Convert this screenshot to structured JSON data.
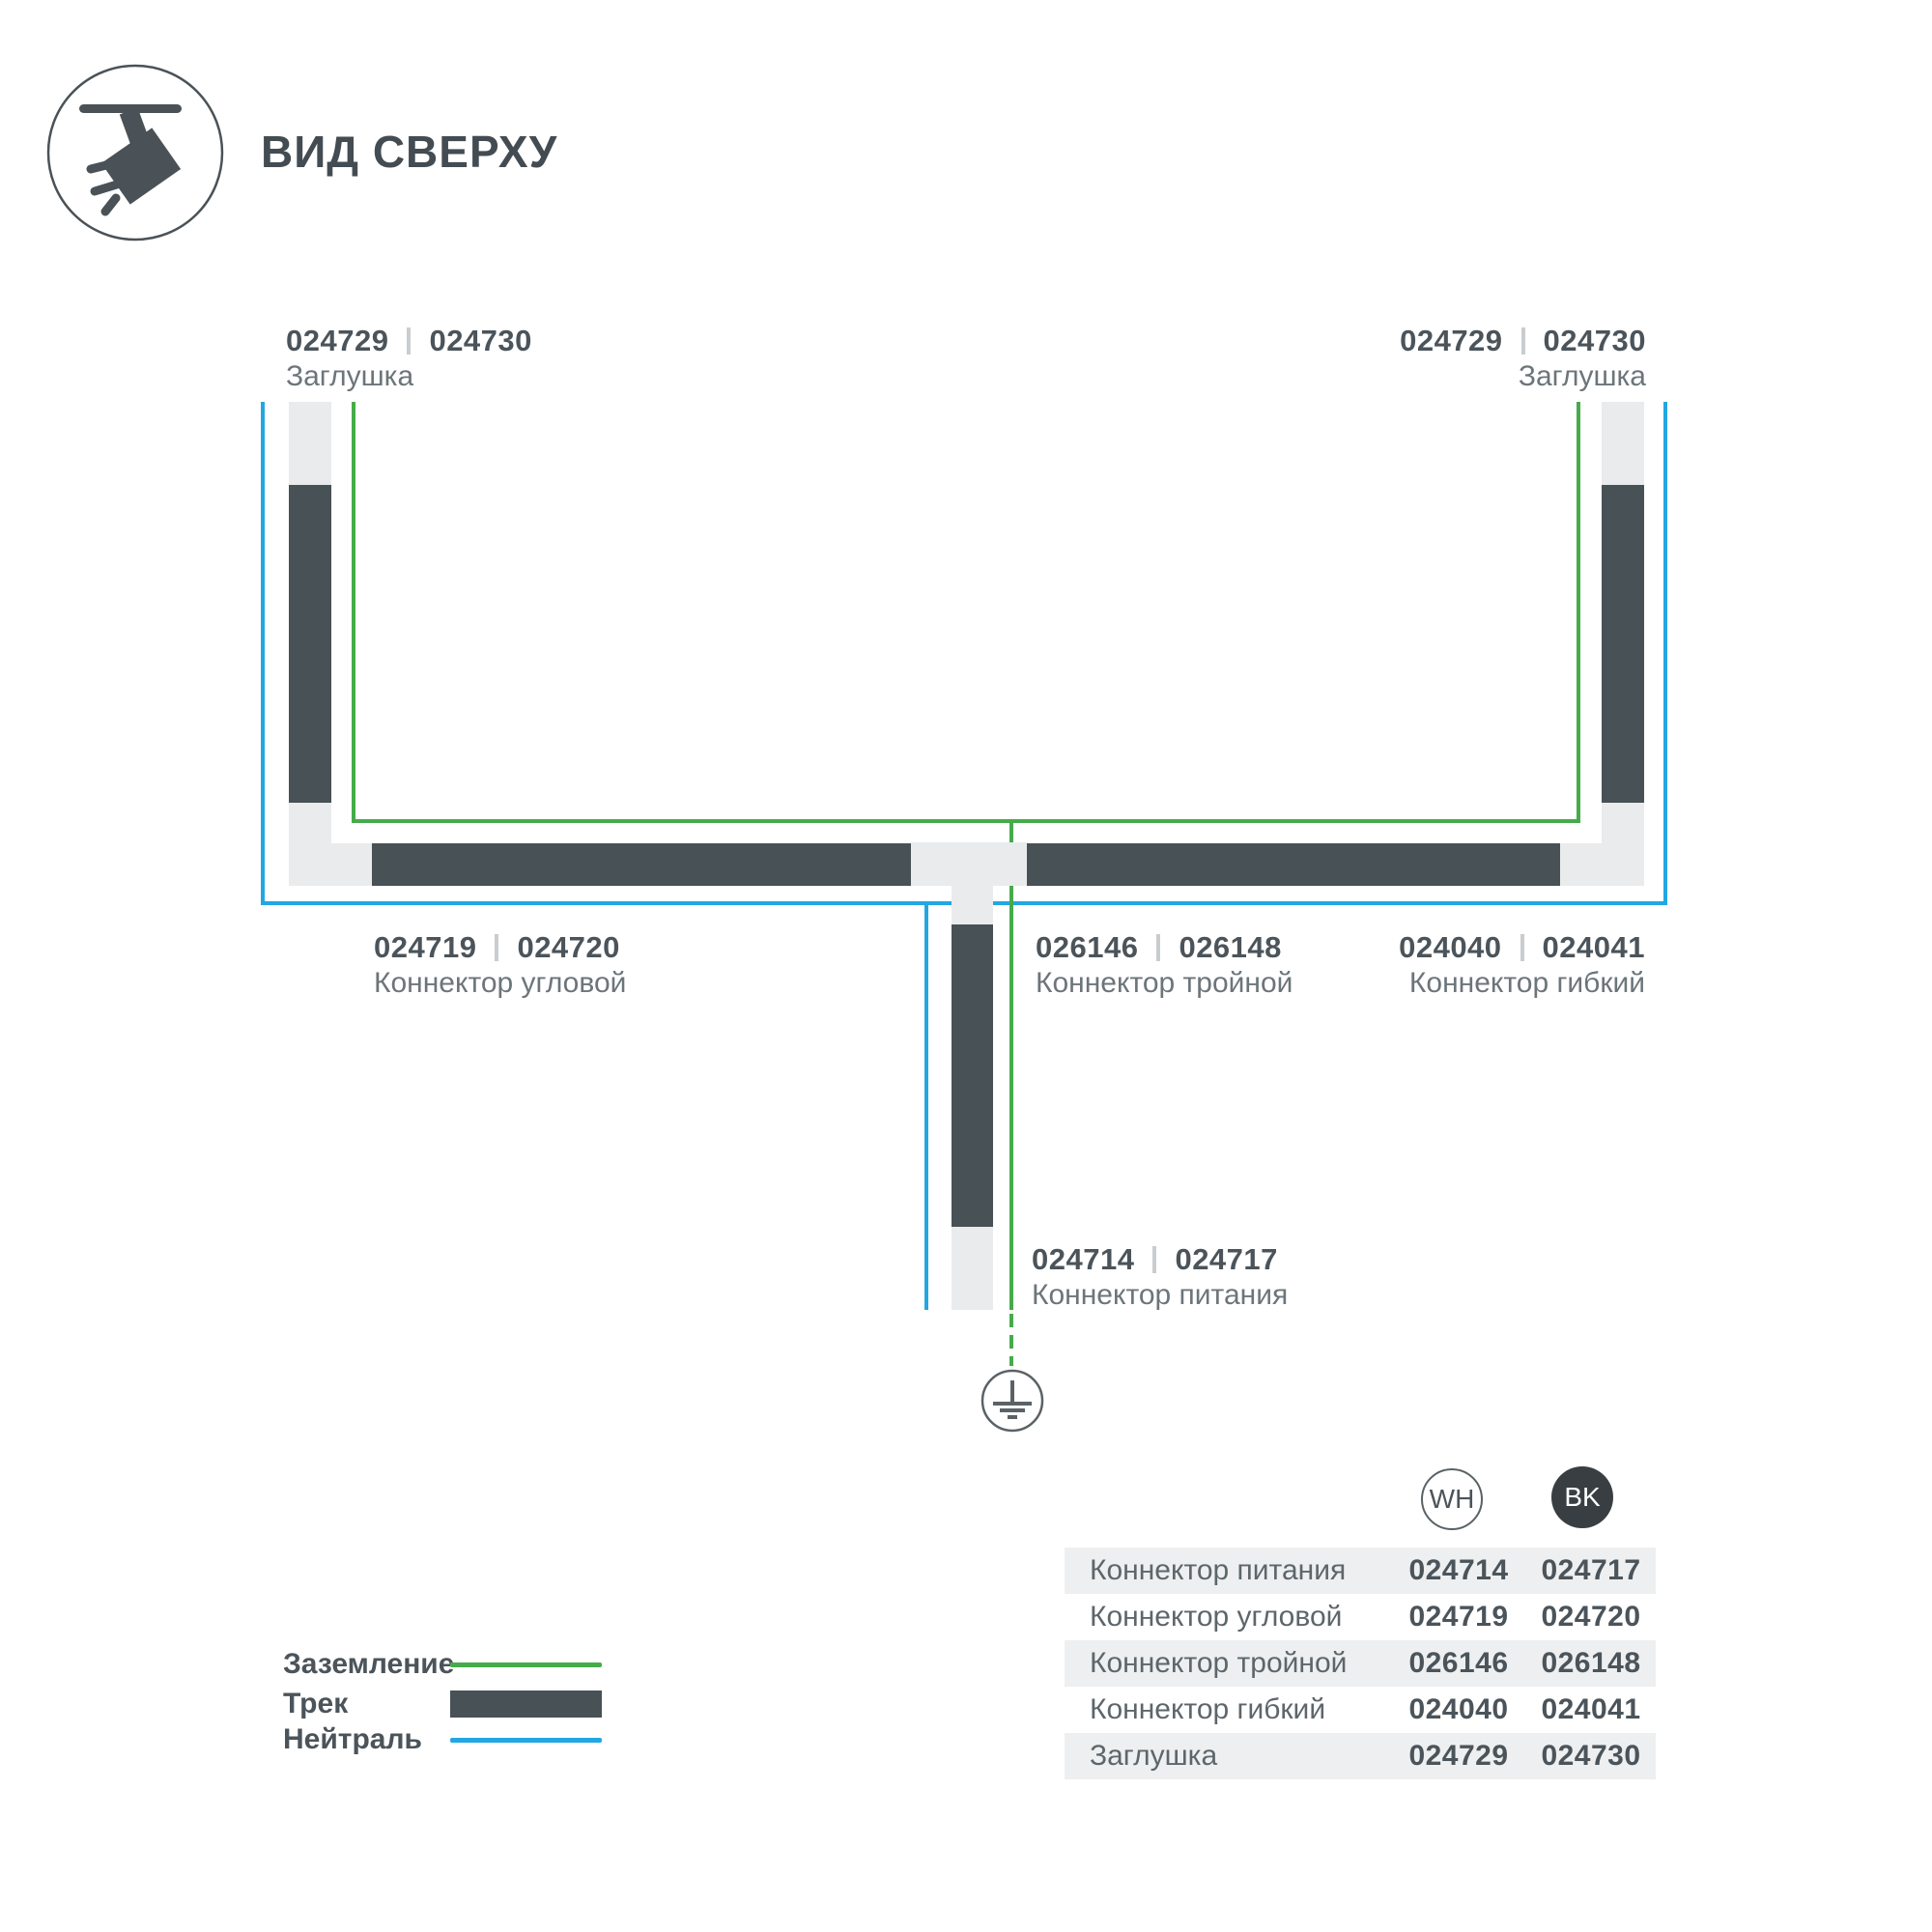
{
  "title": "ВИД СВЕРХУ",
  "colors": {
    "green": "#46ab4a",
    "blue": "#22a7e2",
    "track": "#485156",
    "light": "#e9ebec",
    "rowgray": "#edeff0",
    "dark": "#4b545a",
    "gray": "#6c757a",
    "sep": "#c9cdcf",
    "bk": "#383e41"
  },
  "labels": {
    "cap_left": {
      "code_wh": "024729",
      "code_bk": "024730",
      "name": "Заглушка"
    },
    "cap_right": {
      "code_wh": "024729",
      "code_bk": "024730",
      "name": "Заглушка"
    },
    "corner": {
      "code_wh": "024719",
      "code_bk": "024720",
      "name": "Коннектор угловой"
    },
    "triple": {
      "code_wh": "026146",
      "code_bk": "026148",
      "name": "Коннектор тройной"
    },
    "flexible": {
      "code_wh": "024040",
      "code_bk": "024041",
      "name": "Коннектор гибкий"
    },
    "power": {
      "code_wh": "024714",
      "code_bk": "024717",
      "name": "Коннектор питания"
    }
  },
  "legend": [
    {
      "label": "Заземление",
      "swatch": "green-line"
    },
    {
      "label": "Трек",
      "swatch": "track-bar"
    },
    {
      "label": "Нейтраль",
      "swatch": "blue-line"
    }
  ],
  "table": {
    "columns": {
      "wh": "WH",
      "bk": "BK"
    },
    "rows": [
      {
        "name": "Коннектор питания",
        "wh": "024714",
        "bk": "024717"
      },
      {
        "name": "Коннектор угловой",
        "wh": "024719",
        "bk": "024720"
      },
      {
        "name": "Коннектор тройной",
        "wh": "026146",
        "bk": "026148"
      },
      {
        "name": "Коннектор гибкий",
        "wh": "024040",
        "bk": "024041"
      },
      {
        "name": "Заглушка",
        "wh": "024729",
        "bk": "024730"
      }
    ]
  }
}
